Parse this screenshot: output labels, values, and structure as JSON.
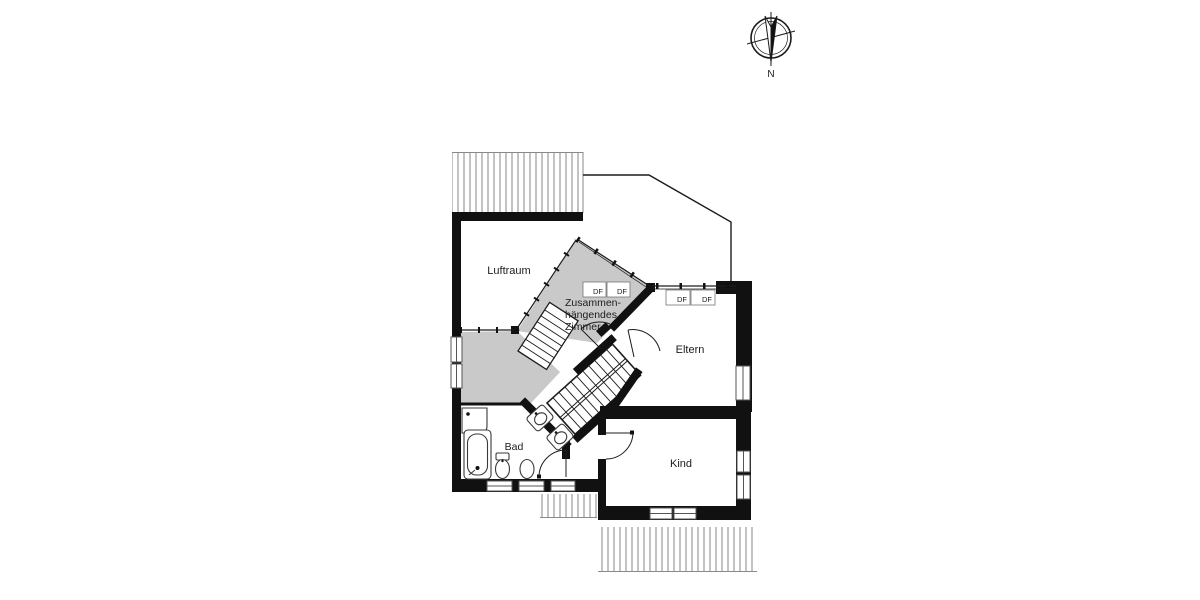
{
  "compass": {
    "north_label": "N"
  },
  "floorplan": {
    "rooms": {
      "luftraum": {
        "label": "Luftraum"
      },
      "zusammenhaengendes_zimmer": {
        "label_lines": [
          "Zusammen-",
          "hängendes",
          "Zimmer"
        ]
      },
      "eltern": {
        "label": "Eltern"
      },
      "kind": {
        "label": "Kind"
      },
      "bad": {
        "label": "Bad"
      }
    },
    "roof_windows": {
      "label": "DF"
    },
    "colors": {
      "wall": "#111111",
      "connected_room_fill": "#c9c9c9",
      "hatch_line": "#9b9b9b",
      "background": "#ffffff"
    }
  }
}
